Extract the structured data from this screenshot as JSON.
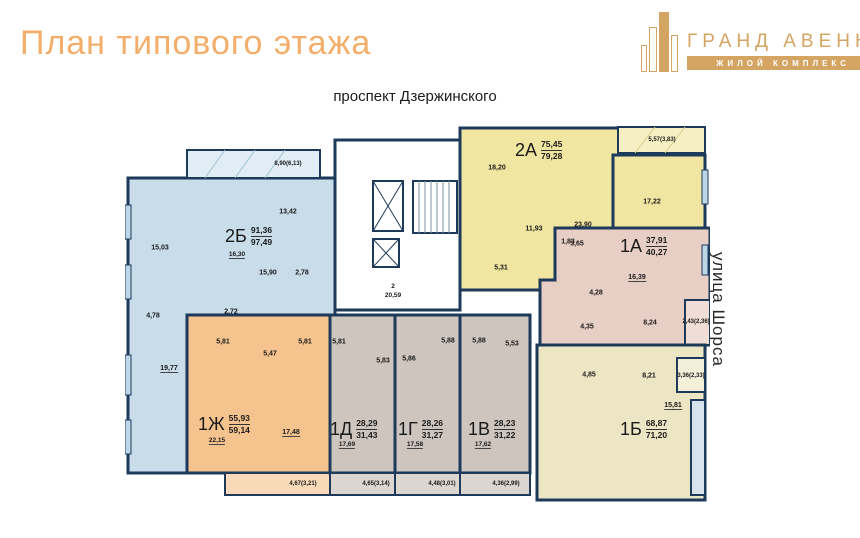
{
  "header": {
    "title": "План типового этажа"
  },
  "logo": {
    "name": "ГРАНД АВЕНЮ",
    "subtitle": "ЖИЛОЙ КОМПЛЕКС"
  },
  "streets": {
    "top": "проспект Дзержинского",
    "right": "улица Шорса"
  },
  "colors": {
    "accent": "#f2ae6a",
    "logo_tan": "#d4a463",
    "wall": "#1e3a5a",
    "apt_2b": "#c8dce9",
    "apt_1zh": "#f5c48e",
    "apt_mid": "#cfc5bf",
    "apt_2a": "#f0e6a2",
    "apt_1a": "#e8cfc5",
    "apt_1b": "#ede6c4"
  },
  "apartments": [
    {
      "code": "2Б",
      "area_living": "91,36",
      "area_total": "97,49",
      "sub": "16,30"
    },
    {
      "code": "2А",
      "area_living": "75,45",
      "area_total": "79,28",
      "sub": ""
    },
    {
      "code": "1А",
      "area_living": "37,91",
      "area_total": "40,27",
      "sub": ""
    },
    {
      "code": "1Б",
      "area_living": "68,87",
      "area_total": "71,20",
      "sub": ""
    },
    {
      "code": "1Ж",
      "area_living": "55,93",
      "area_total": "59,14",
      "sub": "22,15"
    },
    {
      "code": "1Д",
      "area_living": "28,29",
      "area_total": "31,43",
      "sub": "17,69"
    },
    {
      "code": "1Г",
      "area_living": "28,26",
      "area_total": "31,27",
      "sub": "17,58"
    },
    {
      "code": "1В",
      "area_living": "28,23",
      "area_total": "31,22",
      "sub": "17,62"
    }
  ],
  "rooms": {
    "apt2b": [
      "15,03",
      "13,42",
      "15,90",
      "2,78",
      "4,78",
      "19,77",
      "2,72"
    ],
    "apt2b_balcony": "8,90(6,13)",
    "apt2a": [
      "18,20",
      "23,90",
      "11,93",
      "1,83",
      "5,31",
      "17,22"
    ],
    "apt2a_balcony": "5,57(3,83)",
    "apt1a": [
      "16,39",
      "3,65",
      "4,28",
      "4,35",
      "8,24"
    ],
    "apt1a_balcony": "2,43(2,36)",
    "apt1b": [
      "4,85",
      "8,21",
      "15,81"
    ],
    "apt1b_balcony": "3,36(2,33)",
    "apt1zh": [
      "5,81",
      "5,47",
      "5,81",
      "17,48"
    ],
    "mid": [
      "5,81",
      "5,83",
      "5,86",
      "5,88",
      "5,88",
      "5,53"
    ],
    "balconies_bottom": [
      "4,67(3,21)",
      "4,65(3,14)",
      "4,48(3,01)",
      "4,36(2,99)"
    ],
    "corridor_number": "2",
    "corridor_area": "20,59"
  }
}
